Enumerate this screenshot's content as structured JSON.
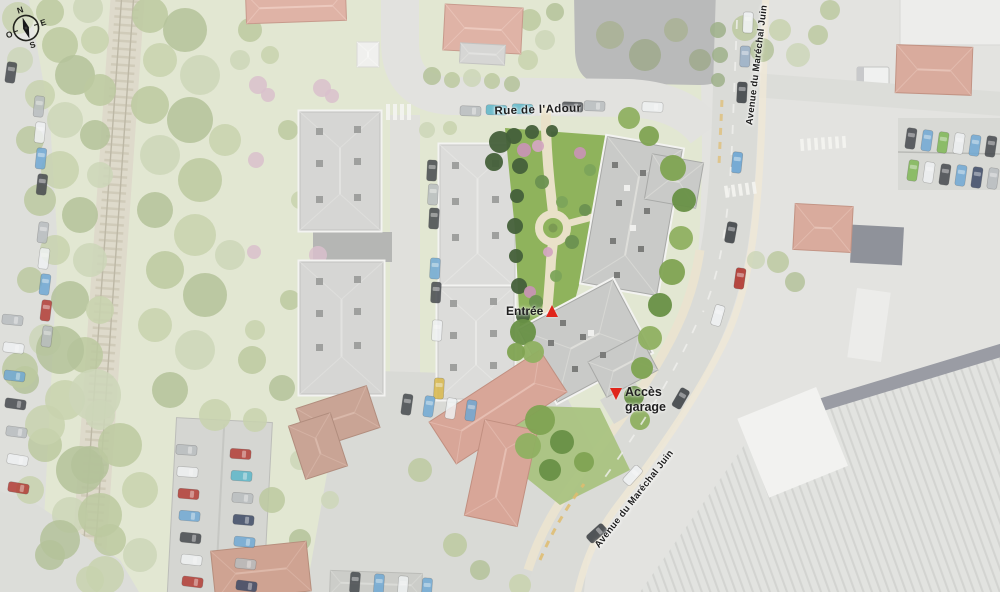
{
  "map": {
    "streets": {
      "rue_adour": "Rue de l'Adour",
      "avenue_top": "Avenue du Maréchal Juin",
      "avenue_bottom": "Avenue du Maréchal Juin"
    },
    "markers": {
      "entree": {
        "label": "Entrée"
      },
      "acces_garage": {
        "label_line1": "Accès",
        "label_line2": "garage"
      }
    },
    "compass": {
      "n": "N",
      "e": "E",
      "s": "S",
      "o": "O"
    },
    "colors": {
      "marker_red": "#e0251b",
      "label_ink": "#1f1f1f",
      "garden_green": "#8fb35c",
      "path_beige": "#e9e1c8",
      "salmon_roof": "#d8a698",
      "road_gray": "#dedfda"
    }
  }
}
